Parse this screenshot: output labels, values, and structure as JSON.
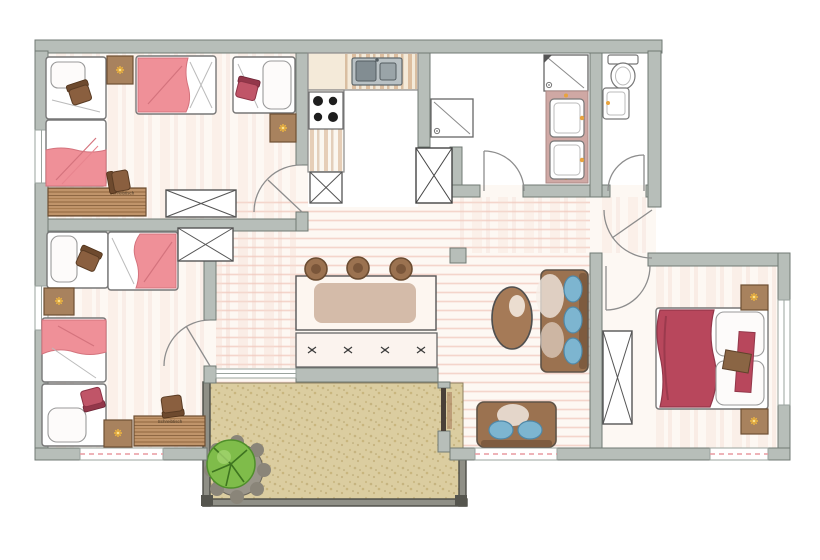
{
  "plan": {
    "kind": "apartment-floor-plan-hand-drawn",
    "desk_label": "Schreibtisch",
    "rooms": [
      {
        "name": "bedroom-top-left",
        "furniture": [
          "single-bed",
          "single-bed",
          "single-bed",
          "single-bed",
          "chair",
          "chair",
          "nightstand-with-lamp",
          "nightstand-with-lamp",
          "desk",
          "desk-chair",
          "wardrobe"
        ]
      },
      {
        "name": "bedroom-bottom-left",
        "furniture": [
          "single-bed",
          "single-bed",
          "single-bed",
          "single-bed",
          "chair",
          "chair",
          "nightstand-with-lamp",
          "nightstand-with-lamp",
          "desk",
          "desk-chair",
          "wardrobe"
        ]
      },
      {
        "name": "kitchen",
        "furniture": [
          "l-shaped-counter",
          "double-sink",
          "stove-4-burners",
          "base-cabinet",
          "tall-cabinet"
        ]
      },
      {
        "name": "bathroom",
        "furniture": [
          "shower",
          "shower",
          "vanity-counter",
          "washbasin",
          "washbasin"
        ]
      },
      {
        "name": "wc",
        "furniture": [
          "toilet",
          "washbasin"
        ]
      },
      {
        "name": "living-dining",
        "furniture": [
          "dining-table",
          "stool",
          "stool",
          "stool",
          "dining-bench",
          "place-setting",
          "place-setting",
          "place-setting",
          "place-setting",
          "sofa",
          "coffee-table",
          "armchair",
          "pillar"
        ]
      },
      {
        "name": "bedroom-master",
        "furniture": [
          "double-bed",
          "wardrobe",
          "nightstand-with-lamp",
          "nightstand-with-lamp"
        ]
      },
      {
        "name": "terrace",
        "furniture": [
          "potted-plant",
          "railing"
        ]
      }
    ],
    "doors": [
      "bedroom-top-left-door",
      "bedroom-bottom-left-door",
      "bathroom-door",
      "wc-door",
      "apartment-entry-door",
      "master-bedroom-door",
      "terrace-door"
    ],
    "window_count": 6,
    "colors": {
      "wall": "#b7beb9",
      "wall_edge": "#707a74",
      "blanket_pink": "#ef9098",
      "blanket_dark_red": "#b8475c",
      "furniture_brown": "#9b7250",
      "nightstand_brown": "#a8825e",
      "lamp_yellow": "#f0b73f",
      "cushion_blue": "#7db5d0",
      "terrace_tan": "#dbcda0",
      "plant_green": "#7fbc4a",
      "floor_stripe_pink": "#f3cfc5",
      "vanity_mauve": "#cfa8a4"
    }
  }
}
